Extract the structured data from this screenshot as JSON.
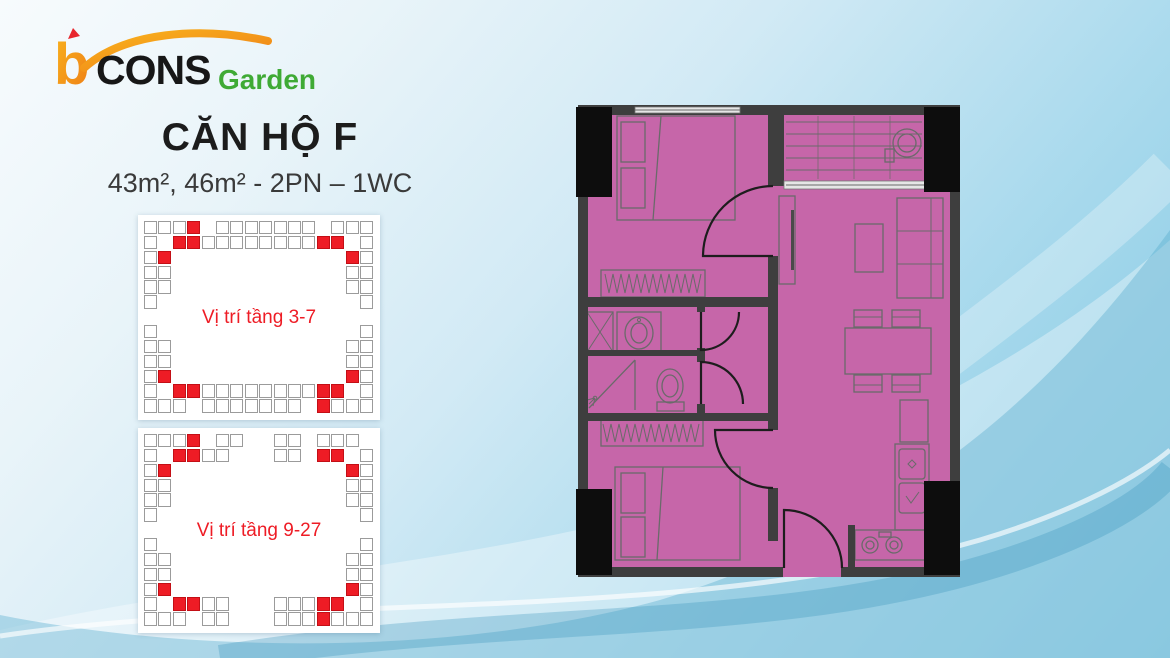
{
  "logo": {
    "b": "b",
    "cons": "CONS",
    "garden": "Garden"
  },
  "title": "CĂN HỘ F",
  "subtitle": "43m², 46m² - 2PN – 1WC",
  "diagrams": [
    {
      "label": "Vị trí tầng 3-7",
      "white_cells": [
        [
          0,
          0
        ],
        [
          1,
          0
        ],
        [
          2,
          0
        ],
        [
          5,
          0
        ],
        [
          6,
          0
        ],
        [
          7,
          0
        ],
        [
          8,
          0
        ],
        [
          9,
          0
        ],
        [
          10,
          0
        ],
        [
          11,
          0
        ],
        [
          13,
          0
        ],
        [
          14,
          0
        ],
        [
          15,
          0
        ],
        [
          0,
          1
        ],
        [
          4,
          1
        ],
        [
          5,
          1
        ],
        [
          6,
          1
        ],
        [
          7,
          1
        ],
        [
          8,
          1
        ],
        [
          9,
          1
        ],
        [
          10,
          1
        ],
        [
          11,
          1
        ],
        [
          15,
          1
        ],
        [
          0,
          2
        ],
        [
          0,
          3
        ],
        [
          0,
          4
        ],
        [
          0,
          5
        ],
        [
          1,
          3
        ],
        [
          1,
          4
        ],
        [
          15,
          2
        ],
        [
          15,
          3
        ],
        [
          15,
          4
        ],
        [
          15,
          5
        ],
        [
          14,
          3
        ],
        [
          14,
          4
        ],
        [
          0,
          7
        ],
        [
          0,
          8
        ],
        [
          0,
          9
        ],
        [
          0,
          10
        ],
        [
          0,
          11
        ],
        [
          1,
          8
        ],
        [
          1,
          9
        ],
        [
          15,
          7
        ],
        [
          15,
          8
        ],
        [
          15,
          9
        ],
        [
          15,
          10
        ],
        [
          15,
          11
        ],
        [
          14,
          8
        ],
        [
          14,
          9
        ],
        [
          4,
          11
        ],
        [
          5,
          11
        ],
        [
          6,
          11
        ],
        [
          7,
          11
        ],
        [
          8,
          11
        ],
        [
          9,
          11
        ],
        [
          10,
          11
        ],
        [
          11,
          11
        ],
        [
          0,
          12
        ],
        [
          1,
          12
        ],
        [
          2,
          12
        ],
        [
          4,
          12
        ],
        [
          5,
          12
        ],
        [
          6,
          12
        ],
        [
          7,
          12
        ],
        [
          8,
          12
        ],
        [
          9,
          12
        ],
        [
          10,
          12
        ],
        [
          13,
          12
        ],
        [
          14,
          12
        ],
        [
          15,
          12
        ]
      ],
      "red_cells": [
        [
          3,
          0
        ],
        [
          2,
          1
        ],
        [
          3,
          1
        ],
        [
          12,
          1
        ],
        [
          13,
          1
        ],
        [
          1,
          2
        ],
        [
          14,
          2
        ],
        [
          1,
          10
        ],
        [
          14,
          10
        ],
        [
          2,
          11
        ],
        [
          3,
          11
        ],
        [
          12,
          11
        ],
        [
          13,
          11
        ],
        [
          12,
          12
        ]
      ]
    },
    {
      "label": "Vị trí tầng 9-27",
      "white_cells": [
        [
          0,
          0
        ],
        [
          1,
          0
        ],
        [
          2,
          0
        ],
        [
          5,
          0
        ],
        [
          6,
          0
        ],
        [
          9,
          0
        ],
        [
          10,
          0
        ],
        [
          12,
          0
        ],
        [
          13,
          0
        ],
        [
          14,
          0
        ],
        [
          0,
          1
        ],
        [
          4,
          1
        ],
        [
          5,
          1
        ],
        [
          9,
          1
        ],
        [
          10,
          1
        ],
        [
          15,
          1
        ],
        [
          0,
          2
        ],
        [
          0,
          3
        ],
        [
          0,
          4
        ],
        [
          0,
          5
        ],
        [
          1,
          3
        ],
        [
          1,
          4
        ],
        [
          15,
          2
        ],
        [
          15,
          3
        ],
        [
          15,
          4
        ],
        [
          15,
          5
        ],
        [
          14,
          3
        ],
        [
          14,
          4
        ],
        [
          0,
          7
        ],
        [
          0,
          8
        ],
        [
          0,
          9
        ],
        [
          0,
          10
        ],
        [
          0,
          11
        ],
        [
          1,
          8
        ],
        [
          1,
          9
        ],
        [
          15,
          7
        ],
        [
          15,
          8
        ],
        [
          15,
          9
        ],
        [
          15,
          10
        ],
        [
          15,
          11
        ],
        [
          14,
          8
        ],
        [
          14,
          9
        ],
        [
          4,
          11
        ],
        [
          5,
          11
        ],
        [
          9,
          11
        ],
        [
          10,
          11
        ],
        [
          11,
          11
        ],
        [
          0,
          12
        ],
        [
          1,
          12
        ],
        [
          2,
          12
        ],
        [
          4,
          12
        ],
        [
          5,
          12
        ],
        [
          9,
          12
        ],
        [
          10,
          12
        ],
        [
          11,
          12
        ],
        [
          13,
          12
        ],
        [
          14,
          12
        ],
        [
          15,
          12
        ]
      ],
      "red_cells": [
        [
          3,
          0
        ],
        [
          2,
          1
        ],
        [
          3,
          1
        ],
        [
          1,
          2
        ],
        [
          12,
          1
        ],
        [
          13,
          1
        ],
        [
          14,
          2
        ],
        [
          1,
          10
        ],
        [
          2,
          11
        ],
        [
          3,
          11
        ],
        [
          14,
          10
        ],
        [
          12,
          11
        ],
        [
          13,
          11
        ],
        [
          12,
          12
        ]
      ]
    }
  ],
  "floorplan": {
    "fill": "#c666a9",
    "wall": "#3e3e3e",
    "column": "#0d0d0d",
    "line": "#6a6a6a"
  },
  "colors": {
    "accent_red": "#ee1c25",
    "logo_orange": "#f9b31d",
    "logo_orange_dark": "#ee7d17",
    "logo_green": "#3faa35",
    "logo_flag_red": "#e8262d",
    "text_dark": "#1c1c1c",
    "cell_border": "#9b9b9b"
  }
}
